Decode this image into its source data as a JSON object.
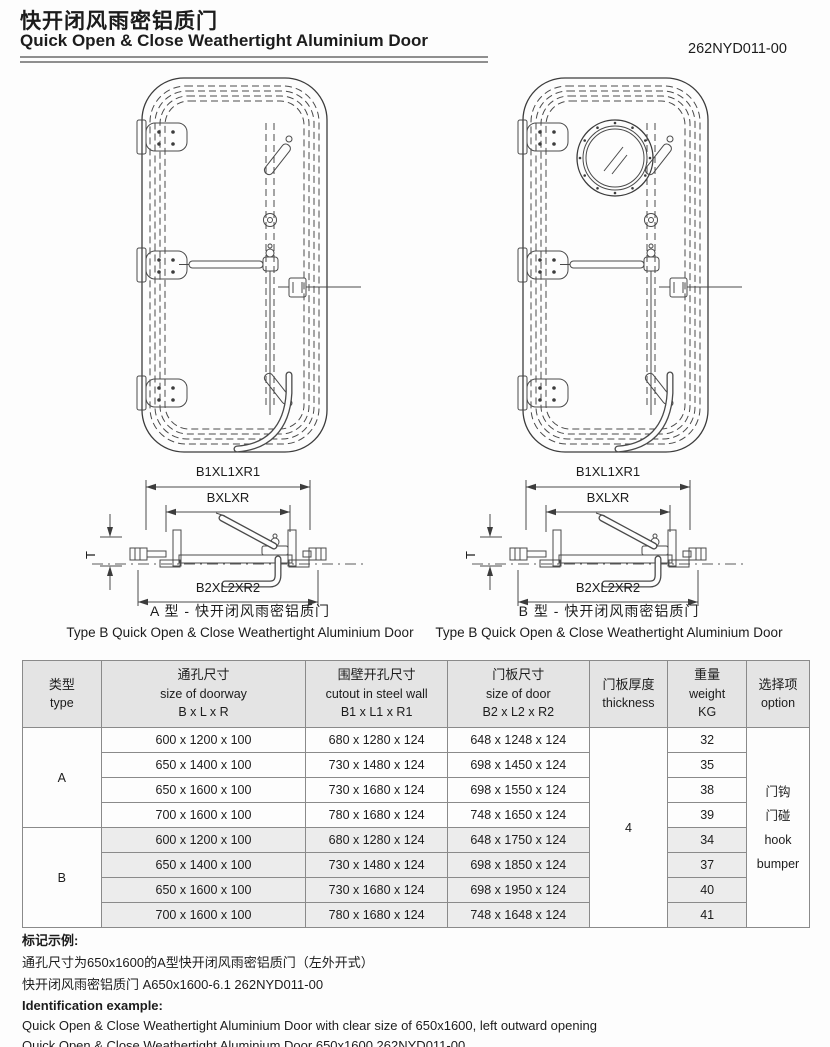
{
  "header": {
    "title_zh": "快开闭风雨密铝质门",
    "title_en": "Quick Open & Close Weathertight Aluminium Door",
    "doc_number": "262NYD011-00"
  },
  "dims": {
    "top": "B1XL1XR1",
    "mid": "BXLXR",
    "bottom": "B2XL2XR2",
    "thickness": "T"
  },
  "captions": {
    "left_zh": "A 型 - 快开闭风雨密铝质门",
    "left_en": "Type B Quick Open & Close Weathertight Aluminium Door",
    "right_zh": "B 型 - 快开闭风雨密铝质门",
    "right_en": "Type B Quick Open & Close Weathertight Aluminium Door"
  },
  "table": {
    "headers": {
      "type_zh": "类型",
      "type_en": "type",
      "doorway_zh": "通孔尺寸",
      "doorway_en": "size of doorway",
      "doorway_sub": "B x L x R",
      "cutout_zh": "围壁开孔尺寸",
      "cutout_en": "cutout in steel wall",
      "cutout_sub": "B1 x L1 x R1",
      "door_zh": "门板尺寸",
      "door_en": "size of door",
      "door_sub": "B2 x L2 x R2",
      "thickness_zh": "门板厚度",
      "thickness_en": "thickness",
      "weight_zh": "重量",
      "weight_en": "weight",
      "weight_sub": "KG",
      "option_zh": "选择项",
      "option_en": "option"
    },
    "thickness_value": "4",
    "option_lines": [
      "门钩",
      "门碰",
      "hook",
      "bumper"
    ],
    "groups": [
      {
        "type": "A",
        "rows": [
          {
            "doorway": "600 x 1200 x 100",
            "cutout": "680 x 1280 x 124",
            "door": "648 x 1248 x 124",
            "weight": "32"
          },
          {
            "doorway": "650 x 1400 x 100",
            "cutout": "730 x 1480 x 124",
            "door": "698 x 1450 x 124",
            "weight": "35"
          },
          {
            "doorway": "650 x 1600 x 100",
            "cutout": "730 x 1680 x 124",
            "door": "698 x 1550 x 124",
            "weight": "38"
          },
          {
            "doorway": "700 x 1600 x 100",
            "cutout": "780 x 1680 x 124",
            "door": "748 x 1650 x 124",
            "weight": "39"
          }
        ]
      },
      {
        "type": "B",
        "rows": [
          {
            "doorway": "600 x 1200 x 100",
            "cutout": "680 x 1280 x 124",
            "door": "648 x 1750 x 124",
            "weight": "34"
          },
          {
            "doorway": "650 x 1400 x 100",
            "cutout": "730 x 1480 x 124",
            "door": "698 x 1850 x 124",
            "weight": "37"
          },
          {
            "doorway": "650 x 1600 x 100",
            "cutout": "730 x 1680 x 124",
            "door": "698 x 1950 x 124",
            "weight": "40"
          },
          {
            "doorway": "700 x 1600 x 100",
            "cutout": "780 x 1680 x 124",
            "door": "748 x 1648 x 124",
            "weight": "41"
          }
        ]
      }
    ]
  },
  "footer": {
    "zh_label": "标记示例:",
    "zh_line1": "通孔尺寸为650x1600的A型快开闭风雨密铝质门（左外开式）",
    "zh_line2": "快开闭风雨密铝质门 A650x1600-6.1 262NYD011-00",
    "en_label": "Identification example:",
    "en_line1": "Quick Open & Close Weathertight Aluminium Door with clear size of 650x1600, left outward opening",
    "en_line2": "Quick Open & Close Weathertight Aluminium Door 650x1600 262NYD011-00"
  }
}
